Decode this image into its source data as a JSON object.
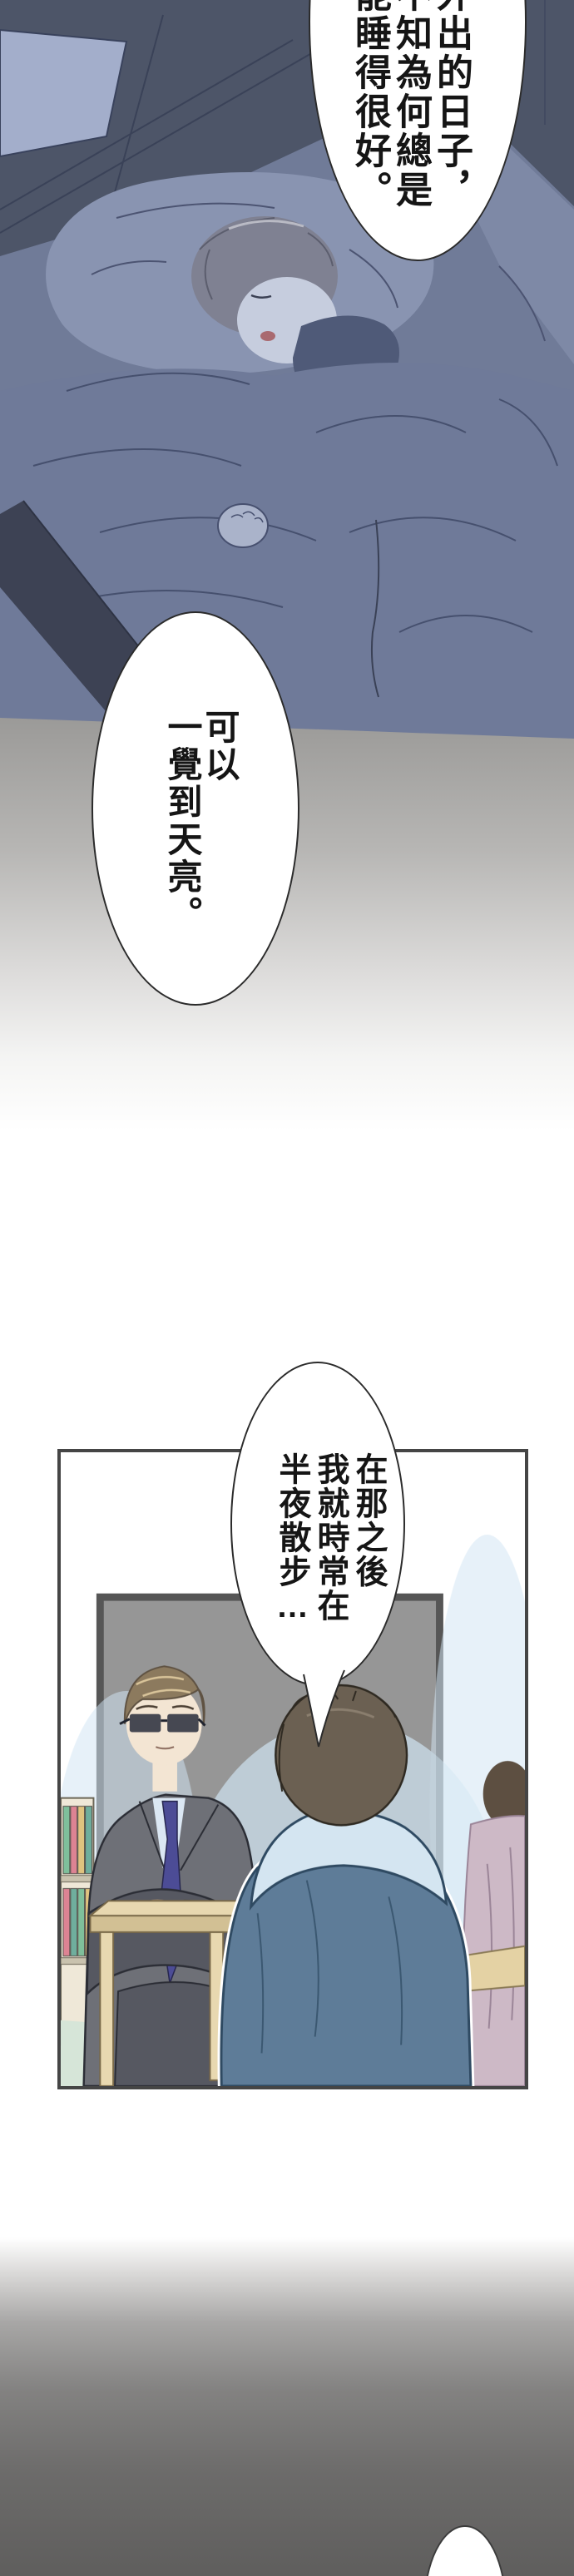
{
  "page_type": "manga-webtoon-strip",
  "bubbles": [
    {
      "name": "bubble-sleep-quality",
      "lines": [
        "外出的日子，",
        "不知為何總是",
        "能睡得很好。"
      ]
    },
    {
      "name": "bubble-sleep-through",
      "lines": [
        "可以",
        "一覺到天亮。"
      ]
    },
    {
      "name": "bubble-night-walks",
      "lines": [
        "在那之後",
        "我就時常在",
        "半夜散步…"
      ]
    },
    {
      "name": "bubble-next-partial",
      "lines": []
    }
  ],
  "colors": {
    "ink": "#151515",
    "bubble-stroke": "#2b2b2b",
    "grad-grey": "#9b9a98",
    "grad-dark": "#5f5e5d",
    "night-wall": "#4d5568",
    "bed-base": "#707b98",
    "headboard": "#a3aecb",
    "pillow": "#8994b1",
    "pillow-right": "#7e89a6",
    "blanket": "#6f7a99",
    "blanket-line": "#46506e",
    "bedframe": "#3d4254",
    "sleeve": "#4f5a78",
    "skin-night": "#c6cdde",
    "hair-night": "#7f8192",
    "hand-night": "#aab3ca",
    "panel-border": "#454545",
    "board": "#969696",
    "board-edge": "#565656",
    "glow": "#d2e6f4",
    "floor": "#d6e5d8",
    "suit": "#6e7077",
    "suit-shadow": "#565861",
    "tie": "#4c4c96",
    "shirt": "#dbe7f3",
    "skin": "#f3e5d3",
    "hair-man": "#8c7a5e",
    "hoodie": "#5e7c98",
    "hood": "#d4e5f1",
    "hair-boy2": "#6b6052",
    "table": "#e8d8b0",
    "table-front": "#d2c094",
    "pink-figure": "#cdb9c6",
    "desk-right": "#e4d2a4",
    "olive": "#b3b08c",
    "shelf": "#efe8d8",
    "book-green": "#7fbf9b",
    "book-red": "#dd8393",
    "book-beige": "#e0c37f",
    "book-teal": "#6fae9d"
  }
}
